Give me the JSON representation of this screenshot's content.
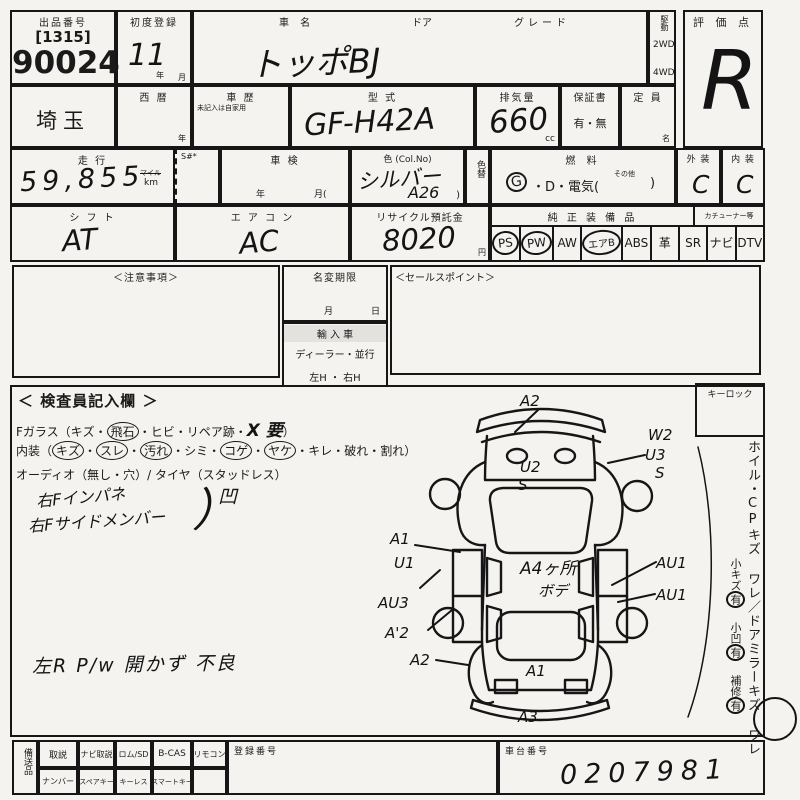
{
  "colors": {
    "paper": "#f4f3ef",
    "ink": "#1a1a1a"
  },
  "header": {
    "lot_label": "出品番号",
    "lot_code": "[1315]",
    "lot_number": "90024",
    "first_reg_label": "初度登録",
    "first_reg_value": "11",
    "year_unit": "年",
    "month_unit": "月",
    "car_name_label": "車  名",
    "car_name_value": "トッポBJ",
    "door_label": "ドア",
    "grade_label": "グレード",
    "drive_label": "駆動",
    "drive_2wd": "2WD",
    "drive_4wd": "4WD",
    "score_label": "評 価 点",
    "score_value": "R"
  },
  "row2": {
    "prefecture": "埼玉",
    "calendar_label": "西  暦",
    "calendar_unit": "年",
    "history_label": "車  歴",
    "history_note": "未記入は自家用",
    "model_label": "型  式",
    "model_value": "GF-H42A",
    "displacement_label": "排気量",
    "displacement_value": "660",
    "displacement_unit": "cc",
    "warranty_label": "保証書",
    "warranty_options": "有・無",
    "capacity_label": "定  員",
    "capacity_unit": "名"
  },
  "row3": {
    "mileage_label": "走  行",
    "mileage_value": "59,855",
    "mile_unit": "マイル",
    "km_unit": "km",
    "s_label": "S#*",
    "inspection_label": "車  検",
    "inspection_year": "年",
    "inspection_month": "月(",
    "color_label": "色 (Col.No)",
    "color_value": "シルバー",
    "color_no": "A26",
    "color_close": ")",
    "color_change_label": "色替",
    "fuel_label": "燃  料",
    "fuel_g": "G",
    "fuel_rest": "・D・電気(",
    "fuel_other": "その他",
    "fuel_close": ")",
    "exterior_label": "外 装",
    "exterior_value": "C",
    "interior_label": "内 装",
    "interior_value": "C"
  },
  "row4": {
    "shift_label": "シ フ ト",
    "shift_value": "AT",
    "aircon_label": "エ ア コ ン",
    "aircon_value": "AC",
    "recycle_label": "リサイクル預託金",
    "recycle_value": "8020",
    "recycle_unit": "円",
    "equipment_label": "純 正 装 備 品",
    "tuner_label": "カチューナー等",
    "equipment_items": [
      {
        "label": "PS",
        "circled": true
      },
      {
        "label": "PW",
        "circled": true
      },
      {
        "label": "AW",
        "circled": false
      },
      {
        "label": "エアB",
        "circled": true
      },
      {
        "label": "ABS",
        "circled": false
      },
      {
        "label": "革",
        "circled": false
      },
      {
        "label": "SR",
        "circled": false
      },
      {
        "label": "ナビ",
        "circled": false
      },
      {
        "label": "DTV",
        "circled": false
      }
    ]
  },
  "row5": {
    "notes_label": "＜注意事項＞",
    "name_change_label": "名変期限",
    "name_change_month": "月",
    "name_change_day": "日",
    "import_label": "輸 入 車",
    "import_options": "ディーラー・並行",
    "handle_options": "左H ・ 右H",
    "sales_label": "＜セールスポイント＞",
    "keylock_label": "キーロック"
  },
  "inspector": {
    "title": "＜ 検査員記入欄 ＞",
    "fglass_p1": "Fガラス（キズ・",
    "fglass_circled": "飛石",
    "fglass_p2": "・ヒビ・リペア跡・",
    "fglass_hand": "X 要",
    "fglass_p3": "）",
    "interior_prefix": "内装（",
    "interior_suffix": "）",
    "interior_items": [
      {
        "label": "キズ",
        "sep": "・",
        "circled": true
      },
      {
        "label": "スレ",
        "sep": "・",
        "circled": true
      },
      {
        "label": "汚れ",
        "sep": "・",
        "circled": true
      },
      {
        "label": "シミ",
        "sep": "・",
        "circled": false
      },
      {
        "label": "コゲ",
        "sep": "・",
        "circled": true
      },
      {
        "label": "ヤケ",
        "sep": "・",
        "circled": true
      },
      {
        "label": "キレ",
        "sep": "・",
        "circled": false
      },
      {
        "label": "破れ",
        "sep": "・",
        "circled": false
      },
      {
        "label": "割れ",
        "sep": "",
        "circled": false
      }
    ],
    "audio_line": "オーディオ（無し・穴）/ タイヤ（スタッドレス）",
    "note1_line1": "右Fインパネ",
    "note1_line2": "右Fサイドメンバー",
    "note1_bracket": "）",
    "note1_tail": "凹",
    "note2": "左R P/w 開かず 不良"
  },
  "diagram": {
    "codes": [
      {
        "label": "A2"
      },
      {
        "label": "W2"
      },
      {
        "label": "U3"
      },
      {
        "label": "S"
      },
      {
        "label": "U2"
      },
      {
        "label": "S"
      },
      {
        "label": "A1"
      },
      {
        "label": "U1"
      },
      {
        "label": "AU3"
      },
      {
        "label": "A'2"
      },
      {
        "label": "A2"
      },
      {
        "label": "A4ヶ所"
      },
      {
        "label": "ボデ"
      },
      {
        "label": "AU1"
      },
      {
        "label": "AU1"
      },
      {
        "label": "A1"
      },
      {
        "label": "A3"
      }
    ]
  },
  "sidebar": {
    "main_text": "ホイル・CPキズ ワレ／ドアミラーキズ ワレ",
    "sub1": "小キズ",
    "sub1_mark": "有",
    "sub2": "小凹",
    "sub2_mark": "有",
    "sub3": "補修",
    "sub3_mark": "有"
  },
  "footer": {
    "vertical_label": "備送品",
    "row1": [
      "取説",
      "ナビ取説",
      "ロム/SD",
      "B-CAS",
      "リモコン"
    ],
    "row2": [
      "ナンバー",
      "スペアキー",
      "キーレス",
      "スマートキー"
    ],
    "reg_no_label": "登録番号",
    "chassis_label": "車台番号",
    "chassis_value": "0207981"
  }
}
